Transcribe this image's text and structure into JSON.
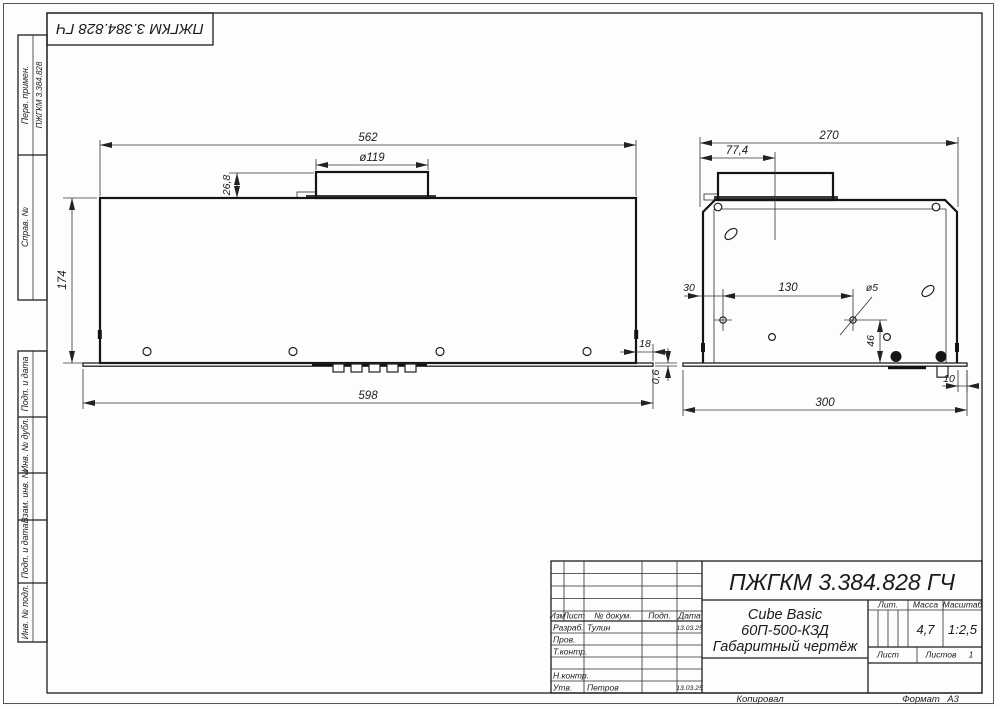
{
  "frame": {
    "stamp_rotated": "ПЖГКМ 3.384.828 ГЧ",
    "copied": "Копировал",
    "format_label": "Формат",
    "format_value": "А3"
  },
  "margin_labels": {
    "perv_primen": "Перв. примен.",
    "perv_primen_value": "ПЖГКМ 3.384.828",
    "sprav_no": "Справ. №",
    "podp_data_top": "Подп. и дата",
    "inv_dubl": "Инв. № дубл.",
    "vzam_inv": "Взам. инв. №",
    "podp_data_bottom": "Подп. и дата",
    "inv_podl": "Инв. № подл."
  },
  "front_view": {
    "dim_top_width": "562",
    "dim_flue_dia": "ø119",
    "dim_flue_height": "26,8",
    "dim_body_height": "174",
    "dim_overhang": "18",
    "dim_panel_thickness": "0,6",
    "dim_panel_width": "598"
  },
  "side_view": {
    "dim_depth": "270",
    "dim_flue_offset": "77,4",
    "dim_hole_edge": "30",
    "dim_hole_span": "130",
    "dim_hole_dia": "ø5",
    "dim_hole_height": "46",
    "dim_overhang": "10",
    "dim_panel_depth": "300"
  },
  "title_block": {
    "doc_number": "ПЖГКМ 3.384.828 ГЧ",
    "product_line1": "Cube Basic",
    "product_line2": "60П-500-КЗД",
    "product_line3": "Габаритный чертёж",
    "col_izm": "Изм",
    "col_list": "Лист",
    "col_doc": "№ докум.",
    "col_podp": "Подп.",
    "col_data": "Дата",
    "row_razrab": "Разраб.",
    "razrab_name": "Тулин",
    "razrab_date": "13.03.25",
    "row_prov": "Пров.",
    "row_tkontr": "Т.контр.",
    "row_nkontr": "Н.контр.",
    "row_utv": "Утв.",
    "utv_name": "Петров",
    "utv_date": "13.03.25",
    "lit_label": "Лит.",
    "massa_label": "Масса",
    "masshtab_label": "Масштаб",
    "massa_value": "4,7",
    "masshtab_value": "1:2,5",
    "list_label": "Лист",
    "listov_label": "Листов",
    "listov_value": "1"
  }
}
